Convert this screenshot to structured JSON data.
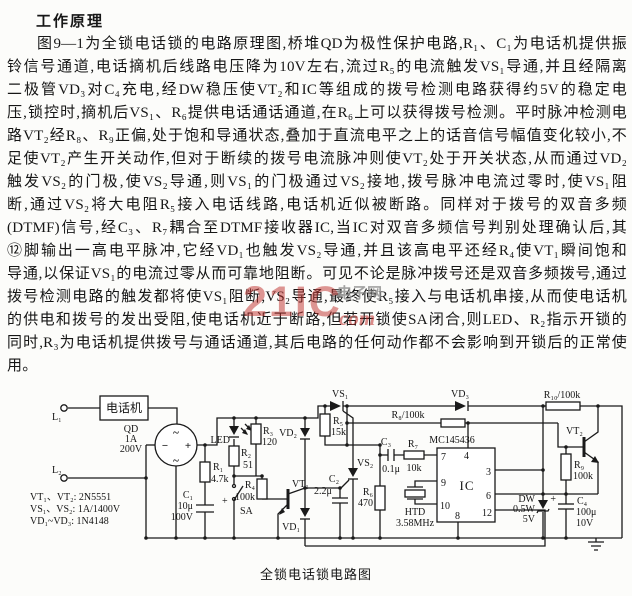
{
  "title": "工作原理",
  "paragraph": {
    "lines": [
      "图9—1为全锁电话锁的电路原理图,桥堆QD为极性保护电路,R₁、C₁为电话机提供振",
      "铃信号通道,电话摘机后线路电压降为10V左右,流过R₅的电流触发VS₁导通,并且经隔离",
      "二极管VD₃对C₄充电,经DW稳压使VT₂和IC等组成的拨号检测电路获得约5V的稳定电",
      "压,锁控时,摘机后VS₁、R₆提供电话通话通道,在R₆上可以获得拨号检测。平时脉冲检测电",
      "路VT₂经R₈、R₉正偏,处于饱和导通状态,叠加于直流电平之上的话音信号幅值变化较小,不",
      "足使VT₂产生开关动作,但对于断续的拨号电流脉冲则使VT₂处于开关状态,从而通过VD₂",
      "触发VS₂的门极,使VS₂导通,则VS₁的门极通过VS₂接地,拨号脉冲电流过零时,使VS₁阻",
      "断,通过VS₂将大电阻R₅接入电话线路,电话机近似被断路。同样对于拨号的双音多频",
      "(DTMF)信号,经C₃、R₇耦合至DTMF接收器IC,当IC对双音多频信号判别处理确认后,其",
      "⑫脚输出一高电平脉冲,它经VD₁也触发VS₂导通,并且该高电平还经R₄使VT₁瞬间饱和",
      "导通,以保证VS₁的电流过零从而可靠地阻断。可见不论是脉冲拨号还是双音多频拨号,通过",
      "拨号检测电路的触发都将使VS₁阻断,VS₂导通,最终使R₅接入与电话机串接,从而使电话机",
      "的供电和拨号的发出受阻,使电话机近于断路,但若开锁使SA闭合,则LED、R₂指示开锁的",
      "同时,R₃为电话机提供拨号与通话通道,其后电路的任何动作都不会影响到开锁后的正常使",
      "用。"
    ]
  },
  "watermark": {
    "brand": "21IC",
    "site": "电子网",
    "suffix": "com"
  },
  "circuit": {
    "caption": "全锁电话锁电路图",
    "terminals": {
      "l1": "L₁",
      "l2": "L₂"
    },
    "phone_box": "电话机",
    "bridge": {
      "name": "QD",
      "current": "1A",
      "voltage": "200V",
      "tilde": "~",
      "plus": "+",
      "minus": "−"
    },
    "labels": {
      "led": "LED",
      "r1": "R₁",
      "r1v": "4.7k",
      "r2": "R₂",
      "r2v": "51",
      "r3": "R₃",
      "r3v": "120",
      "r4": "R₄",
      "r4v": "100k",
      "r5": "R₅",
      "r5v": "15k",
      "r6": "R₆",
      "r6v": "470",
      "r7": "R₇",
      "r7v": "10k",
      "r8": "R₈/100k",
      "r9": "R₉",
      "r9v": "100k",
      "r10": "R₁₀/100k",
      "c1": "C₁",
      "c1v": "10μ",
      "c1vv": "100V",
      "c1plus": "+",
      "c2": "C₂",
      "c2v": "2.2μ",
      "c3": "C₃",
      "c3v": "0.1μ",
      "c4": "C₄",
      "c4v": "100μ",
      "c4vv": "10V",
      "c4plus": "+",
      "sa": "SA",
      "vt1": "VT₁",
      "vt2": "VT₂",
      "vd1": "VD₁",
      "vd2": "VD₂",
      "vd3": "VD₃",
      "vs1": "VS₁",
      "vs2": "VS₂",
      "dw": "DW",
      "dwv": "0.5W",
      "dwv2": "5V",
      "ic_part": "MC145436",
      "ic": "IC",
      "xtal": "HTD",
      "xtalv": "3.58MHz"
    },
    "ic_pins": {
      "p3": "3",
      "p4": "4",
      "p6": "6",
      "p7": "7",
      "p8": "8",
      "p9": "9",
      "p10": "10",
      "p12": "12"
    },
    "parts_list": [
      "VT₁、VT₂:  2N5551",
      "VS₁、VS₂:  1A/1400V",
      "VD₁~VD₃:  1N4148"
    ]
  },
  "colors": {
    "ink": "#1a1a1a",
    "watermark_red": "#c0302c",
    "watermark_gray": "#8d8d8d"
  }
}
